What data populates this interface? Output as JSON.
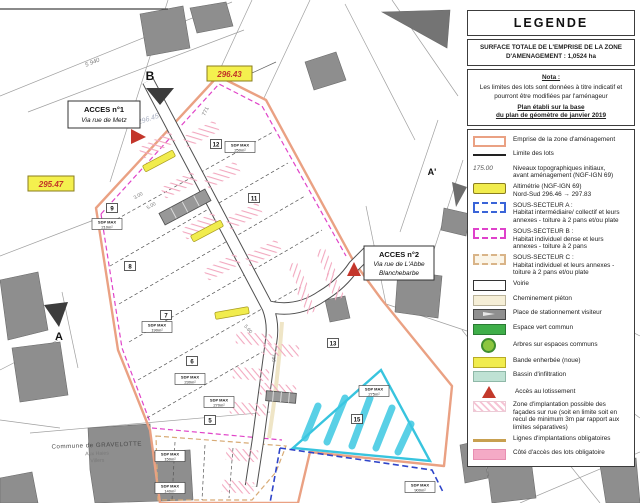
{
  "colors": {
    "emprise": "#eaa183",
    "bande": "#f1ec4d",
    "bassin_hatch": "#3cc8e2",
    "sous_secteur_b": "#e044c8",
    "sous_secteur_a": "#2f45c9",
    "espace_vert": "#3fae49",
    "zone_implantation": "#f2a8bf",
    "acces": "#c3362b"
  },
  "map": {
    "markers": {
      "b": "B",
      "a": "A",
      "a_prime": "A'"
    },
    "access1": {
      "title": "ACCES n°1",
      "line2": "Via rue de Metz"
    },
    "access2": {
      "title": "ACCES n°2",
      "line2": "Via rue de L'Abbe",
      "line3": "Blanchebarbe"
    },
    "altimetry": [
      {
        "value": "296.43"
      },
      {
        "value": "295.47"
      }
    ],
    "pencil_note": "296.45",
    "road_label": "5 940",
    "dims": [
      "771",
      "3.00",
      "5.00",
      "5.60",
      "750"
    ],
    "lots": [
      {
        "num": "12"
      },
      {
        "num": "11"
      },
      {
        "num": "9"
      },
      {
        "num": "8"
      },
      {
        "num": "7"
      },
      {
        "num": "6"
      },
      {
        "num": "5"
      },
      {
        "num": "13"
      },
      {
        "num": "15"
      }
    ],
    "sdp": [
      {
        "l1": "SDP MAX",
        "l2": "210m²"
      },
      {
        "l1": "SDP MAX",
        "l2": "250m²"
      },
      {
        "l1": "SDP MAX",
        "l2": "190m²"
      },
      {
        "l1": "SDP MAX",
        "l2": "230m²"
      },
      {
        "l1": "SDP MAX",
        "l2": "270m²"
      },
      {
        "l1": "SDP MAX",
        "l2": "275m²"
      },
      {
        "l1": "SDP MAX",
        "l2": "900m²"
      },
      {
        "l1": "SDP MAX",
        "l2": "150m²"
      },
      {
        "l1": "SDP MAX",
        "l2": "140m²"
      }
    ],
    "commune": {
      "line1": "Commune de GRAVELOTTE",
      "line2": "Aux Haies",
      "line3": "Villers"
    }
  },
  "legend": {
    "title": "LEGENDE",
    "surface_line1": "SURFACE TOTALE DE L'EMPRISE DE LA ZONE",
    "surface_line2": "D'AMENAGEMENT : 1,0524 ha",
    "nota_title": "Nota :",
    "nota_body": "Les limites des lots sont données à titre indicatif et pourront être modifiées par l'aménageur",
    "nota_basis_line1": "Plan établi sur la base",
    "nota_basis_line2": "du plan de géomètre de janvier 2019",
    "items": [
      {
        "label": "Emprise de la zone d'aménagement"
      },
      {
        "label": "Limite des lots"
      },
      {
        "label": "Niveaux topographiques initiaux,",
        "label2": "avant aménagement (NGF-IGN 69)",
        "swatch_text": "175.00"
      },
      {
        "label": "Altimétrie (NGF-IGN 69)",
        "label2": "Nord-Sud 296.46 → 297.83"
      },
      {
        "label": "SOUS-SECTEUR A :",
        "label2": "Habitat intermédiaire/ collectif et leurs annexes - toiture à 2 pans et/ou plate"
      },
      {
        "label": "SOUS-SECTEUR B :",
        "label2": "Habitat individuel dense et leurs annexes - toiture à 2 pans"
      },
      {
        "label": "SOUS-SECTEUR C :",
        "label2": "Habitat individuel et leurs annexes - toiture à 2 pans et/ou plate"
      },
      {
        "label": "Voirie"
      },
      {
        "label": "Cheminement piéton"
      },
      {
        "label": "Place de stationnement visiteur"
      },
      {
        "label": "Espace vert commun"
      },
      {
        "label": "Arbres sur espaces communs"
      },
      {
        "label": "Bande enherbée (noue)"
      },
      {
        "label": "Bassin d'infiltration"
      },
      {
        "label": "Accès au lotissement"
      },
      {
        "label": "Zone d'implantation possible des façades sur rue (soit en limite soit en recul de minimum 3m par rapport aux limites séparatives)"
      },
      {
        "label": "Lignes d'implantations obligatoires"
      },
      {
        "label": "Côté d'accès des lots obligatoire"
      }
    ]
  }
}
